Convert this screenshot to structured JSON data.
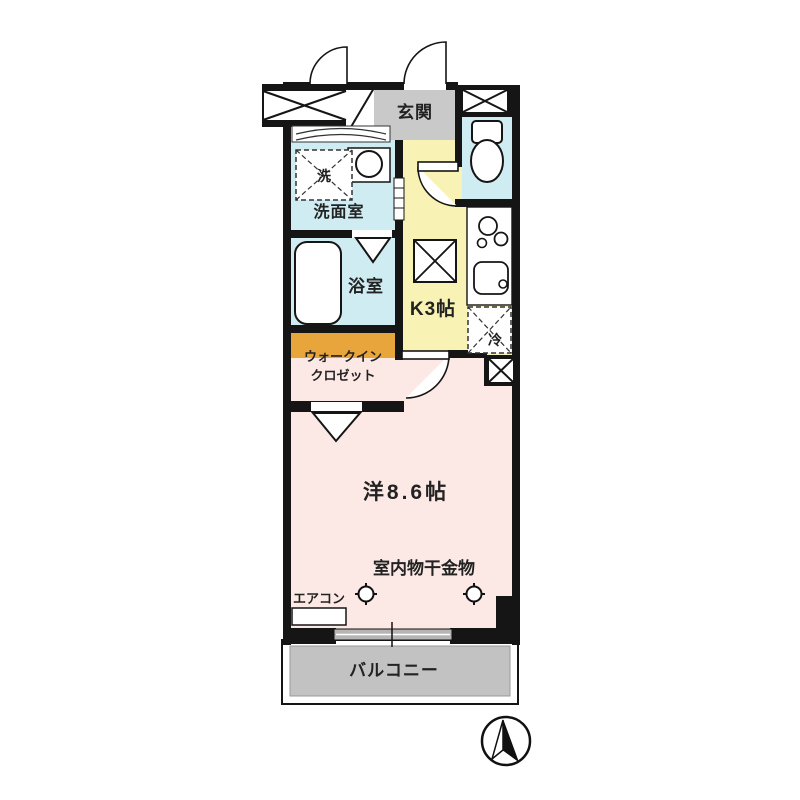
{
  "plan": {
    "type": "japanese-apartment-floor-plan",
    "rooms": {
      "genkan": "玄関",
      "washroom": "洗面室",
      "bathroom": "浴室",
      "walkin_line1": "ウォークイン",
      "walkin_line2": "クロゼット",
      "kitchen": "K3帖",
      "main_room": "洋8.6帖",
      "balcony": "バルコニー"
    },
    "fixtures": {
      "washer": "洗",
      "fridge": "冷"
    },
    "annotations": {
      "laundry_hardware": "室内物干金物",
      "aircon": "エアコン"
    },
    "icons": {
      "compass": "north-arrow",
      "laundry_anchor": "cross-circle-mark",
      "pipe_shaft": "x-box",
      "meter_box": "x-box"
    },
    "colors": {
      "wall": "#151515",
      "water_rooms": "#cfecf2",
      "kitchen": "#f8f3b4",
      "main_room": "#fce9e5",
      "walkin_closet": "#e8a53c",
      "genkan": "#c9c9c9",
      "balcony": "#c2c2c2"
    }
  }
}
